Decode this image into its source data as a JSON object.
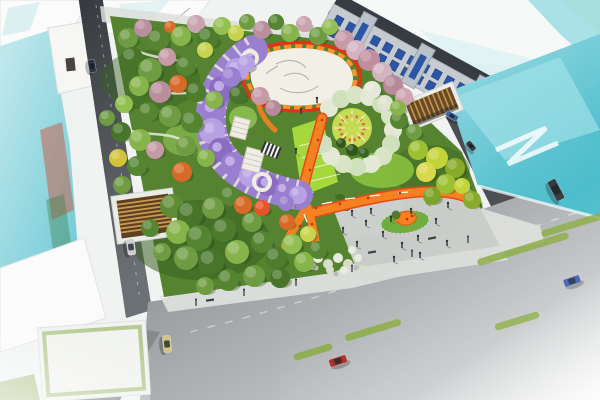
{
  "palette": {
    "bg": "#f1f3f3",
    "buildingWhite": "#fafbfa",
    "buildingEdge": "#dfe4e5",
    "glassTeal": "#7fd0da",
    "glassTealLight": "#c5eaee",
    "glassDeep": "#49bccb",
    "roadDark": "#43474b",
    "roadMid": "#85898c",
    "boulevardLight": "#c6c9ca",
    "sidewalk": "#dadcd9",
    "parkGreen": "#55832f",
    "parkDark": "#3a6123",
    "lawnLime": "#8cc63f",
    "lawnBright": "#a6d83c",
    "plazaWhite": "#f2efe6",
    "plazaGray": "#c9ccc8",
    "plazaGrayLight": "#d9dbd8",
    "orange": "#f58120",
    "orangeDeep": "#e8481c",
    "red": "#d02814",
    "purple": "#9a7fd1",
    "purpleLight": "#b7a1e3",
    "pergolaWhite": "#efece2",
    "cherry": "#c79aa8",
    "slatDark": "#5f3f1e",
    "slatLight": "#c89a52",
    "rowFacade": "#c6cbd0",
    "rowRoof": "#363c42",
    "windowBlue": "#2c55a5",
    "treeShadow": "#1e3a10",
    "personDark": "#2c3135",
    "islandGreen": "#6fae3e",
    "laneGreen": "#86a93c"
  },
  "scene": {
    "trees": [
      [
        128,
        38,
        10,
        "#6f9c42"
      ],
      [
        143,
        28,
        9,
        "#b98f9e"
      ],
      [
        158,
        40,
        11,
        "#558531"
      ],
      [
        170,
        27,
        6,
        "#d86a28"
      ],
      [
        181,
        36,
        10,
        "#86b44b"
      ],
      [
        196,
        24,
        9,
        "#c9a3b0"
      ],
      [
        208,
        38,
        11,
        "#4e7c2d"
      ],
      [
        222,
        26,
        9,
        "#93bf52"
      ],
      [
        236,
        33,
        8,
        "#c7d34a"
      ],
      [
        247,
        22,
        8,
        "#6f9c42"
      ],
      [
        262,
        30,
        9,
        "#b98f9e"
      ],
      [
        276,
        22,
        8,
        "#558531"
      ],
      [
        290,
        33,
        9,
        "#86b44b"
      ],
      [
        304,
        24,
        8,
        "#c9a3b0"
      ],
      [
        318,
        36,
        9,
        "#6f9c42"
      ],
      [
        330,
        27,
        8,
        "#93bf52"
      ],
      [
        344,
        40,
        10,
        "#c79aa8"
      ],
      [
        356,
        50,
        10,
        "#d4b3c0"
      ],
      [
        369,
        60,
        11,
        "#c08e9d"
      ],
      [
        382,
        72,
        10,
        "#d4b3c0"
      ],
      [
        393,
        85,
        10,
        "#b8899a"
      ],
      [
        404,
        97,
        9,
        "#cfa4b2"
      ],
      [
        372,
        90,
        9,
        "#e4e8d8"
      ],
      [
        385,
        103,
        8,
        "#dfe3d0"
      ],
      [
        132,
        58,
        11,
        "#48752a"
      ],
      [
        150,
        70,
        12,
        "#6f9c42"
      ],
      [
        167,
        57,
        9,
        "#c79aa8"
      ],
      [
        186,
        66,
        10,
        "#558531"
      ],
      [
        139,
        86,
        10,
        "#86b44b"
      ],
      [
        160,
        92,
        11,
        "#b98f9e"
      ],
      [
        178,
        84,
        9,
        "#d86a28"
      ],
      [
        196,
        92,
        10,
        "#4e7c2d"
      ],
      [
        124,
        104,
        9,
        "#93bf52"
      ],
      [
        148,
        112,
        10,
        "#558531"
      ],
      [
        170,
        116,
        11,
        "#6f9c42"
      ],
      [
        205,
        50,
        8,
        "#c9d44e"
      ],
      [
        121,
        132,
        10,
        "#48752a"
      ],
      [
        140,
        140,
        11,
        "#86b44b"
      ],
      [
        118,
        158,
        9,
        "#d3c23a"
      ],
      [
        137,
        166,
        10,
        "#558531"
      ],
      [
        155,
        150,
        9,
        "#c79aa8"
      ],
      [
        122,
        185,
        9,
        "#6f9c42"
      ],
      [
        107,
        118,
        8,
        "#6f9c42"
      ],
      [
        192,
        122,
        11,
        "#558531"
      ],
      [
        214,
        100,
        9,
        "#86b44b"
      ],
      [
        238,
        95,
        9,
        "#48752a"
      ],
      [
        186,
        146,
        10,
        "#6f9c42"
      ],
      [
        206,
        158,
        9,
        "#86b44b"
      ],
      [
        182,
        172,
        10,
        "#d86a28"
      ],
      [
        230,
        196,
        10,
        "#558531"
      ],
      [
        172,
        206,
        12,
        "#5d8c35"
      ],
      [
        190,
        214,
        13,
        "#48752a"
      ],
      [
        213,
        208,
        11,
        "#6f9c42"
      ],
      [
        178,
        232,
        12,
        "#86b44b"
      ],
      [
        199,
        238,
        13,
        "#558531"
      ],
      [
        224,
        230,
        12,
        "#4e7c2d"
      ],
      [
        186,
        258,
        12,
        "#6f9c42"
      ],
      [
        211,
        262,
        13,
        "#48752a"
      ],
      [
        237,
        252,
        12,
        "#86b44b"
      ],
      [
        262,
        242,
        11,
        "#558531"
      ],
      [
        252,
        222,
        10,
        "#6f9c42"
      ],
      [
        276,
        258,
        11,
        "#4e7c2d"
      ],
      [
        292,
        244,
        10,
        "#93bf52"
      ],
      [
        228,
        280,
        11,
        "#558531"
      ],
      [
        254,
        276,
        11,
        "#6f9c42"
      ],
      [
        280,
        278,
        10,
        "#48752a"
      ],
      [
        304,
        262,
        10,
        "#86b44b"
      ],
      [
        318,
        250,
        9,
        "#558531"
      ],
      [
        243,
        205,
        9,
        "#d86a28"
      ],
      [
        262,
        208,
        8,
        "#e8542a"
      ],
      [
        287,
        222,
        8,
        "#d86a28"
      ],
      [
        308,
        234,
        8,
        "#c9d44e"
      ],
      [
        205,
        286,
        9,
        "#6f9c42"
      ],
      [
        162,
        252,
        9,
        "#6f9c42"
      ],
      [
        150,
        228,
        9,
        "#558531"
      ],
      [
        418,
        150,
        10,
        "#9cc032"
      ],
      [
        437,
        158,
        11,
        "#c2d438"
      ],
      [
        455,
        168,
        10,
        "#88aa28"
      ],
      [
        426,
        172,
        10,
        "#d8d84a"
      ],
      [
        446,
        184,
        10,
        "#9cc032"
      ],
      [
        462,
        186,
        8,
        "#c2d438"
      ],
      [
        432,
        196,
        9,
        "#7ba428"
      ],
      [
        414,
        132,
        8,
        "#6f9c42"
      ],
      [
        399,
        120,
        9,
        "#558531"
      ],
      [
        472,
        200,
        9,
        "#88aa28"
      ],
      [
        398,
        108,
        8,
        "#86b44b"
      ],
      [
        231,
        77,
        10,
        "#9a7fd1"
      ],
      [
        246,
        64,
        9,
        "#b7a1e3"
      ],
      [
        286,
        203,
        8,
        "#9a7fd1"
      ],
      [
        260,
        96,
        9,
        "#c79aa8"
      ],
      [
        273,
        108,
        8,
        "#b8899a"
      ],
      [
        352,
        150,
        6,
        "#31571e"
      ],
      [
        341,
        143,
        5,
        "#31571e"
      ],
      [
        364,
        153,
        5,
        "#3a6424"
      ]
    ],
    "tunnelBlobs": [
      [
        253,
        55,
        11
      ],
      [
        237,
        70,
        12
      ],
      [
        222,
        89,
        13
      ],
      [
        213,
        110,
        13
      ],
      [
        212,
        131,
        13
      ],
      [
        220,
        150,
        12
      ],
      [
        233,
        164,
        12
      ],
      [
        250,
        176,
        11
      ],
      [
        268,
        185,
        11
      ],
      [
        285,
        191,
        10
      ],
      [
        298,
        195,
        9
      ]
    ],
    "tunnelColors": [
      "#9a7fd1",
      "#b7a1e3",
      "#8a6cc0"
    ],
    "crescent": {
      "cx": 352,
      "cy": 128,
      "blobs": [
        [
          329,
          108
        ],
        [
          341,
          99
        ],
        [
          355,
          95
        ],
        [
          369,
          97
        ],
        [
          381,
          104
        ],
        [
          390,
          116
        ],
        [
          393,
          130
        ],
        [
          391,
          144
        ],
        [
          383,
          156
        ],
        [
          371,
          164
        ],
        [
          357,
          167
        ],
        [
          343,
          164
        ],
        [
          331,
          156
        ],
        [
          323,
          144
        ]
      ],
      "blobColors": [
        "#e3e9d4",
        "#cfe0bc",
        "#d9e4c6"
      ],
      "spokes": [
        0,
        45,
        90,
        135,
        180,
        225,
        270,
        315
      ],
      "spokeR1": 7,
      "spokeR2": 18
    },
    "cars": [
      [
        131,
        247,
        82,
        16,
        8,
        "#ccd0d4"
      ],
      [
        92,
        66,
        80,
        13,
        7,
        "#2c3644"
      ],
      [
        167,
        344,
        84,
        17,
        8,
        "#d2c782"
      ],
      [
        338,
        361,
        -18,
        18,
        8,
        "#a8281e"
      ],
      [
        572,
        281,
        -18,
        17,
        8,
        "#3a57a8"
      ],
      [
        556,
        190,
        62,
        22,
        9,
        "#2e353d"
      ],
      [
        452,
        116,
        31,
        13,
        6,
        "#41639f"
      ],
      [
        471,
        146,
        50,
        11,
        6,
        "#384049"
      ]
    ],
    "bikeLanes": [
      [
        523,
        249,
        95
      ],
      [
        575,
        224,
        70
      ],
      [
        373,
        330,
        58
      ],
      [
        517,
        321,
        46
      ],
      [
        313,
        352,
        40
      ]
    ],
    "laneAngle": -17,
    "people": [
      [
        352,
        216
      ],
      [
        366,
        226
      ],
      [
        383,
        237
      ],
      [
        402,
        248
      ],
      [
        418,
        241
      ],
      [
        436,
        224
      ],
      [
        448,
        208
      ],
      [
        371,
        214
      ],
      [
        391,
        222
      ],
      [
        411,
        214
      ],
      [
        427,
        204
      ],
      [
        343,
        233
      ],
      [
        357,
        247
      ],
      [
        394,
        262
      ],
      [
        420,
        258
      ],
      [
        447,
        246
      ],
      [
        301,
        114
      ],
      [
        317,
        103
      ],
      [
        296,
        154
      ]
    ],
    "redDots": [
      [
        299,
        206
      ],
      [
        316,
        208
      ],
      [
        308,
        194
      ],
      [
        312,
        224
      ],
      [
        340,
        204
      ],
      [
        368,
        198
      ],
      [
        400,
        193
      ],
      [
        432,
        192
      ],
      [
        300,
        226
      ],
      [
        288,
        240
      ],
      [
        322,
        120
      ],
      [
        318,
        140
      ],
      [
        310,
        170
      ]
    ],
    "whiteMarks": [
      [
        309,
        200,
        313,
        192
      ],
      [
        304,
        214,
        307,
        222
      ],
      [
        322,
        204,
        332,
        202
      ],
      [
        345,
        199,
        355,
        198
      ],
      [
        370,
        196,
        380,
        195
      ],
      [
        398,
        193,
        408,
        192
      ]
    ],
    "flowers": [
      [
        318,
        258,
        5
      ],
      [
        328,
        264,
        5
      ],
      [
        338,
        258,
        5
      ],
      [
        348,
        264,
        5
      ],
      [
        358,
        258,
        4
      ],
      [
        330,
        270,
        4
      ],
      [
        344,
        270,
        4
      ],
      [
        312,
        266,
        4
      ],
      [
        352,
        250,
        4
      ],
      [
        322,
        252,
        4
      ],
      [
        305,
        256,
        4
      ],
      [
        362,
        268,
        3
      ]
    ],
    "flowerColors": [
      "#e7ebdd",
      "#d7ddc9"
    ],
    "rocks": [
      [
        316,
        268
      ],
      [
        336,
        274
      ],
      [
        356,
        268
      ],
      [
        309,
        262
      ]
    ],
    "lamps": [
      [
        196,
        306
      ],
      [
        244,
        296
      ],
      [
        296,
        286
      ],
      [
        352,
        272
      ],
      [
        412,
        257
      ],
      [
        468,
        243
      ]
    ],
    "benches": [
      [
        372,
        252,
        -10
      ],
      [
        432,
        238,
        -12
      ],
      [
        210,
        300,
        -8
      ]
    ],
    "rowWindows": {
      "count": 13,
      "spacing": 14,
      "rows": [
        8,
        21
      ],
      "w": 8,
      "h": 9
    }
  }
}
